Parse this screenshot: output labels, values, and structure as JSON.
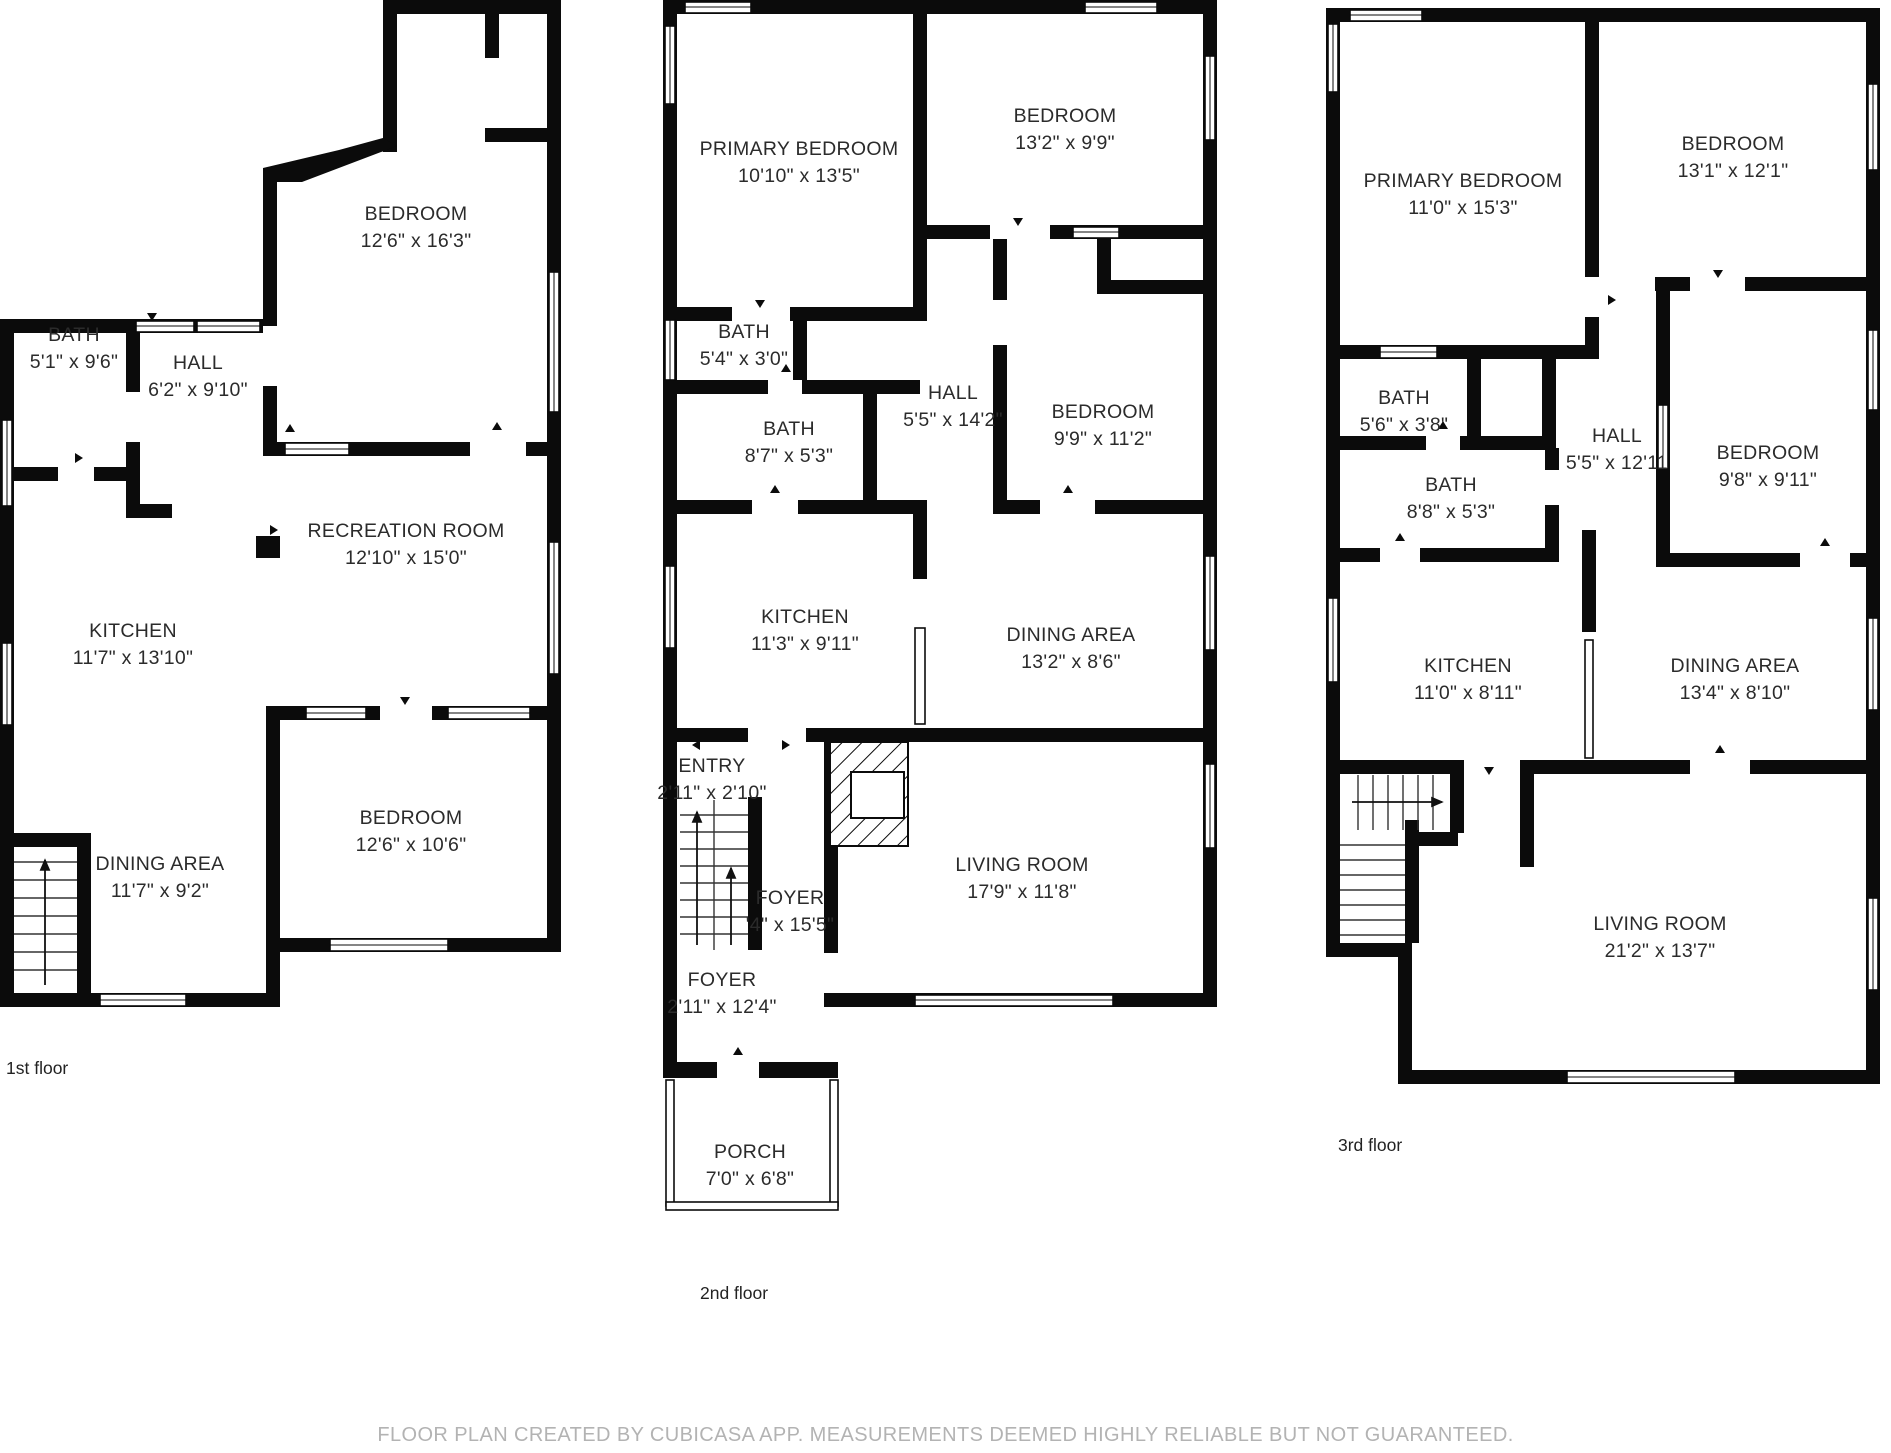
{
  "page": {
    "background": "#ffffff",
    "wall_color": "#0b0b0b",
    "footer": "FLOOR PLAN CREATED BY CUBICASA APP. MEASUREMENTS DEEMED HIGHLY RELIABLE BUT NOT GUARANTEED."
  },
  "floors": [
    {
      "label": "1st floor",
      "rooms": [
        {
          "name": "BEDROOM",
          "dims": "12'6\" x 16'3\""
        },
        {
          "name": "BATH",
          "dims": "5'1\" x 9'6\""
        },
        {
          "name": "HALL",
          "dims": "6'2\" x 9'10\""
        },
        {
          "name": "RECREATION ROOM",
          "dims": "12'10\" x 15'0\""
        },
        {
          "name": "KITCHEN",
          "dims": "11'7\" x 13'10\""
        },
        {
          "name": "DINING AREA",
          "dims": "11'7\" x 9'2\""
        },
        {
          "name": "BEDROOM",
          "dims": "12'6\" x 10'6\""
        }
      ]
    },
    {
      "label": "2nd floor",
      "rooms": [
        {
          "name": "PRIMARY BEDROOM",
          "dims": "10'10\" x 13'5\""
        },
        {
          "name": "BEDROOM",
          "dims": "13'2\" x 9'9\""
        },
        {
          "name": "BATH",
          "dims": "5'4\" x 3'0\""
        },
        {
          "name": "BATH",
          "dims": "8'7\" x 5'3\""
        },
        {
          "name": "HALL",
          "dims": "5'5\" x 14'2\""
        },
        {
          "name": "BEDROOM",
          "dims": "9'9\" x 11'2\""
        },
        {
          "name": "KITCHEN",
          "dims": "11'3\" x 9'11\""
        },
        {
          "name": "DINING AREA",
          "dims": "13'2\" x 8'6\""
        },
        {
          "name": "ENTRY",
          "dims": "2'11\" x 2'10\""
        },
        {
          "name": "FOYER",
          "dims": "'4\" x 15'5\""
        },
        {
          "name": "LIVING ROOM",
          "dims": "17'9\" x 11'8\""
        },
        {
          "name": "FOYER",
          "dims": "2'11\" x 12'4\""
        },
        {
          "name": "PORCH",
          "dims": "7'0\" x 6'8\""
        }
      ]
    },
    {
      "label": "3rd floor",
      "rooms": [
        {
          "name": "PRIMARY BEDROOM",
          "dims": "11'0\" x 15'3\""
        },
        {
          "name": "BEDROOM",
          "dims": "13'1\" x 12'1\""
        },
        {
          "name": "BATH",
          "dims": "5'6\" x 3'8\""
        },
        {
          "name": "BATH",
          "dims": "8'8\" x 5'3\""
        },
        {
          "name": "HALL",
          "dims": "5'5\" x 12'11"
        },
        {
          "name": "BEDROOM",
          "dims": "9'8\" x 9'11\""
        },
        {
          "name": "KITCHEN",
          "dims": "11'0\" x 8'11\""
        },
        {
          "name": "DINING AREA",
          "dims": "13'4\" x 8'10\""
        },
        {
          "name": "LIVING ROOM",
          "dims": "21'2\" x 13'7\""
        }
      ]
    }
  ]
}
